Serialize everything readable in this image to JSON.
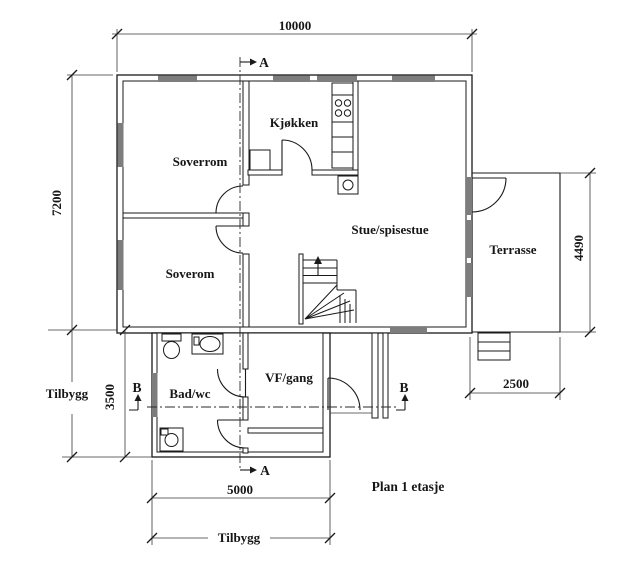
{
  "drawing": {
    "title": "Plan 1 etasje",
    "rooms": {
      "soverrom": "Soverrom",
      "soverom": "Soverom",
      "kjokken": "Kjøkken",
      "stue": "Stue/spisestue",
      "terrasse": "Terrasse",
      "bad": "Bad/wc",
      "vf": "VF/gang"
    },
    "dimensions": {
      "top_width": "10000",
      "left_height": "7200",
      "tilbygg_height": "3500",
      "terrasse_height": "4490",
      "terrasse_width": "2500",
      "tilbygg_width": "5000"
    },
    "annotations": {
      "tilbygg_left": "Tilbygg",
      "tilbygg_bottom": "Tilbygg"
    },
    "sections": {
      "a": "A",
      "b": "B"
    },
    "colors": {
      "line": "#1a1a1a",
      "window_fill": "#7d7d7d",
      "background": "#ffffff"
    }
  }
}
